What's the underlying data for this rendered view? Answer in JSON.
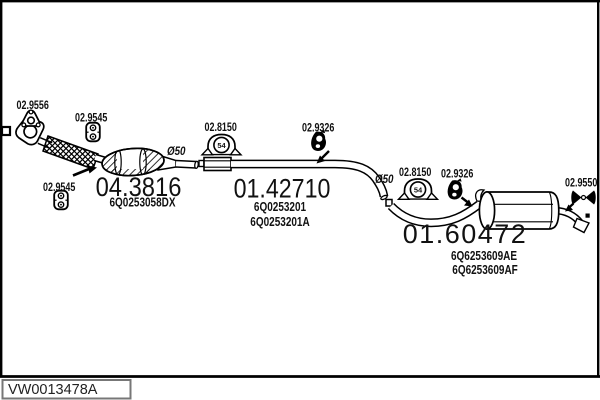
{
  "vehicle_code": "VW0013478A",
  "sections": {
    "front": {
      "part_number": "04.3816",
      "oem": "6Q0253058DX"
    },
    "middle": {
      "part_number": "01.42710",
      "oem_a": "6Q0253201",
      "oem_b": "6Q0253201A"
    },
    "rear": {
      "part_number": "01.60472",
      "oem_a": "6Q6253609AE",
      "oem_b": "6Q6253609AF"
    }
  },
  "fittings": {
    "flange_gasket": "02.9556",
    "rubber_hanger": "02.9545",
    "clamp": "02.8150",
    "clamp_size": "54",
    "rubber_mount": "02.9326",
    "rear_hanger": "02.9550"
  },
  "annotations": {
    "pipe_diameter": "Ø50"
  },
  "colors": {
    "line": "#000000",
    "background": "#ffffff",
    "code_box_border": "#777777"
  }
}
